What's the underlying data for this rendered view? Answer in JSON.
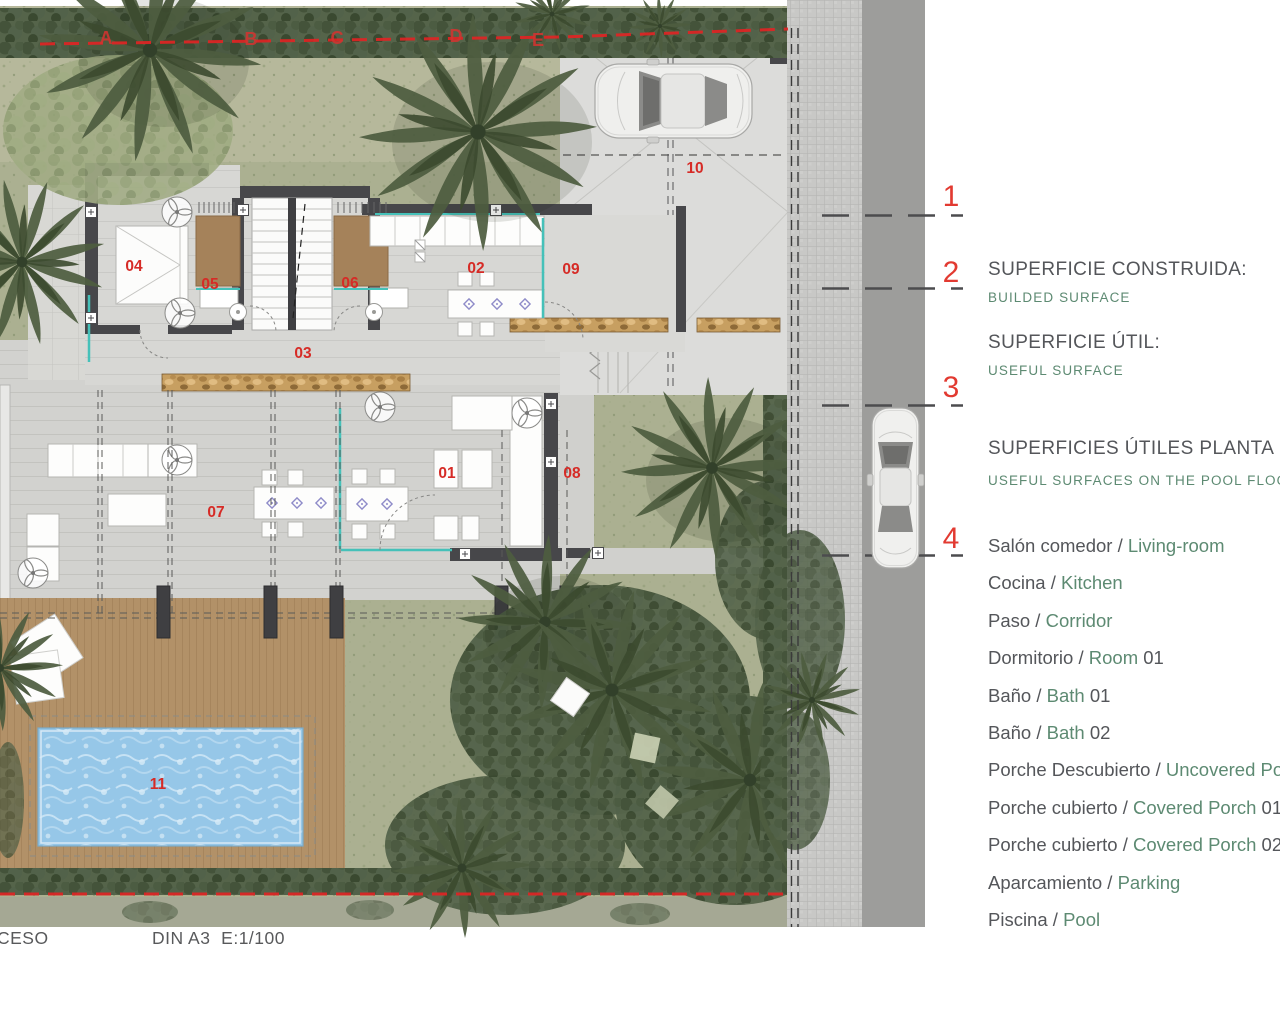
{
  "plan": {
    "room_labels": [
      {
        "text": "01"
      },
      {
        "text": "02"
      },
      {
        "text": "03"
      },
      {
        "text": "04"
      },
      {
        "text": "05"
      },
      {
        "text": "06"
      },
      {
        "text": "07"
      },
      {
        "text": "08"
      },
      {
        "text": "09"
      },
      {
        "text": "10"
      },
      {
        "text": "11"
      }
    ],
    "grid_letters": [
      {
        "text": "A"
      },
      {
        "text": "B"
      },
      {
        "text": "C"
      },
      {
        "text": "D"
      },
      {
        "text": "E"
      }
    ]
  },
  "markers": [
    {
      "number": "1"
    },
    {
      "number": "2"
    },
    {
      "number": "3"
    },
    {
      "number": "4"
    }
  ],
  "legend": {
    "sep": " / ",
    "sections": [
      {
        "title_es": "SUPERFICIE CONSTRUIDA:",
        "title_en": "BUILDED SURFACE"
      },
      {
        "title_es": "SUPERFICIE ÚTIL:",
        "title_en": "USEFUL SURFACE"
      },
      {
        "title_es": "SUPERFICIES ÚTILES PLANTA",
        "title_en": "USEFUL SURFACES ON THE POOL FLOOR:"
      }
    ],
    "items": [
      {
        "es": "Salón comedor",
        "en": "Living-room",
        "suffix": ""
      },
      {
        "es": "Cocina",
        "en": "Kitchen",
        "suffix": ""
      },
      {
        "es": "Paso",
        "en": "Corridor",
        "suffix": ""
      },
      {
        "es": "Dormitorio",
        "en": "Room",
        "suffix": " 01"
      },
      {
        "es": "Baño",
        "en": "Bath",
        "suffix": " 01"
      },
      {
        "es": "Baño",
        "en": "Bath",
        "suffix": " 02"
      },
      {
        "es": "Porche Descubierto",
        "en": "Uncovered Porch",
        "suffix": ""
      },
      {
        "es": "Porche cubierto",
        "en": "Covered Porch",
        "suffix": " 01"
      },
      {
        "es": "Porche cubierto",
        "en": "Covered Porch",
        "suffix": " 02"
      },
      {
        "es": "Aparcamiento",
        "en": "Parking",
        "suffix": ""
      },
      {
        "es": "Piscina",
        "en": "Pool",
        "suffix": ""
      }
    ]
  },
  "titleblock": {
    "left": "CESO",
    "scale": "DIN A3  E:1/100"
  },
  "colors": {
    "accent_red": "#d62b26",
    "marker_red": "#e23a31",
    "text_dark": "#54565a",
    "text_green": "#5d8a72",
    "grass": "#abb091",
    "pool": "#96c7e8",
    "deck": "#b29168",
    "road": "#9d9d9b",
    "wall": "#47474a"
  }
}
